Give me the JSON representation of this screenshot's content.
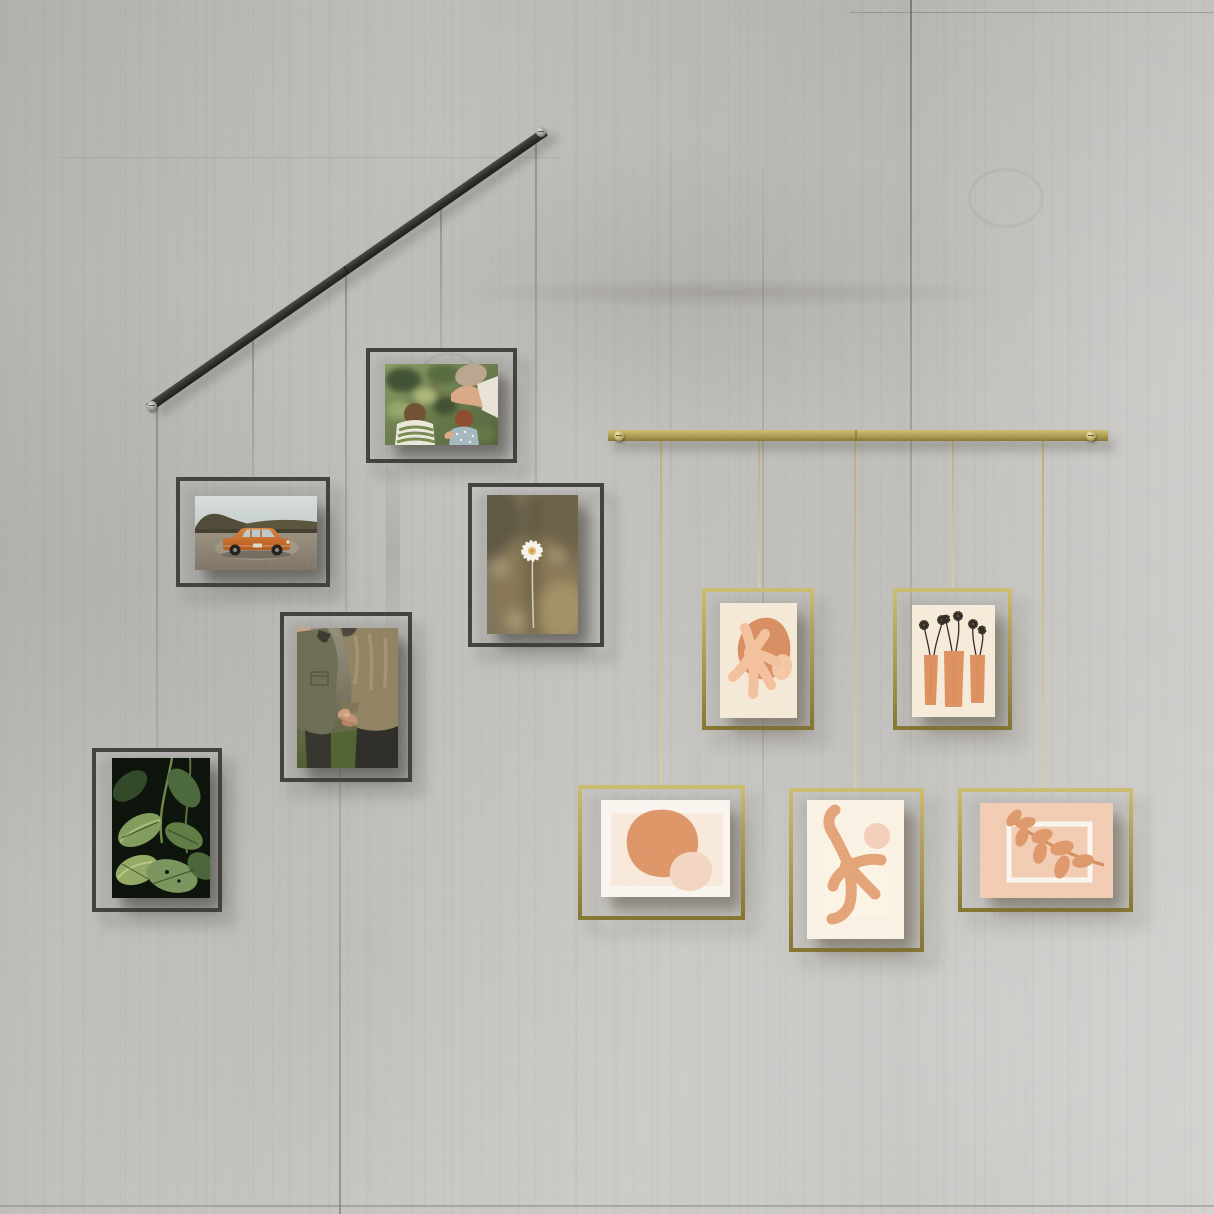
{
  "scene": {
    "type": "product lifestyle photo",
    "description": "Two picture-hanging rail systems with floating frames suspended by wires on a concrete wall",
    "wall": {
      "material": "concrete",
      "base_color": "#c1c0bd",
      "seam_color": "#6f6d68"
    }
  },
  "rails": [
    {
      "id": "black-rail",
      "label": "black metal hanging rail",
      "color": "#2e2c2a",
      "orientation": "diagonal",
      "screws": 2,
      "frames_hung": 5
    },
    {
      "id": "brass-rail",
      "label": "brass hanging rail",
      "color": "#ab9b4f",
      "orientation": "horizontal",
      "screws": 2,
      "frames_hung": 5
    }
  ],
  "wires": {
    "black_rail_wire_color": "#8f8f8d",
    "brass_rail_wire_color": "#d3c68e",
    "count": 10
  },
  "frames": [
    {
      "id": "family-garden",
      "rail": "black-rail",
      "orientation": "landscape",
      "frame_color": "#413f3b",
      "description": "Photo of two children and an adult picking berries in a garden",
      "palette": [
        "#87975f",
        "#5a6a41",
        "#b7a48c",
        "#e9e7d8",
        "#8a4a2c"
      ]
    },
    {
      "id": "vintage-car",
      "rail": "black-rail",
      "orientation": "landscape",
      "frame_color": "#413f3b",
      "description": "Photo of an orange vintage sedan parked on gravel below dark hills",
      "palette": [
        "#d3dad8",
        "#4e4936",
        "#968b7a",
        "#c96f2a"
      ]
    },
    {
      "id": "holding-hands",
      "rail": "black-rail",
      "orientation": "portrait",
      "frame_color": "#413f3b",
      "description": "Photo of a couple in field jackets holding hands",
      "palette": [
        "#6b6a52",
        "#8e8060",
        "#c89a79",
        "#51602f"
      ]
    },
    {
      "id": "daisy",
      "rail": "black-rail",
      "orientation": "portrait",
      "frame_color": "#413f3b",
      "description": "Photo of a single white daisy against blurred grasses",
      "palette": [
        "#7d7257",
        "#f5f2ea",
        "#e0bd6d"
      ]
    },
    {
      "id": "green-leaves",
      "rail": "black-rail",
      "orientation": "portrait",
      "frame_color": "#413f3b",
      "description": "Photo of dark tropical foliage",
      "palette": [
        "#0c120b",
        "#77935a",
        "#c8d296"
      ]
    },
    {
      "id": "coral-abstract",
      "rail": "brass-rail",
      "orientation": "portrait",
      "frame_color": "#ac9c51",
      "description": "Abstract print of a peach coral shape over a terracotta blob",
      "palette": [
        "#f4e8d5",
        "#d68c5f",
        "#f2bf9b"
      ]
    },
    {
      "id": "flower-vases",
      "rail": "brass-rail",
      "orientation": "portrait",
      "frame_color": "#ac9c51",
      "description": "Print of three orange vases with sketched black daisies",
      "palette": [
        "#f6ead8",
        "#dd8f5e",
        "#2e2820"
      ]
    },
    {
      "id": "terracotta-blob",
      "rail": "brass-rail",
      "orientation": "landscape",
      "frame_color": "#ac9c51",
      "description": "Print of a large terracotta blob with a pale peach pebble",
      "palette": [
        "#f9f4ee",
        "#f7e8da",
        "#dd9466",
        "#f2d4bf"
      ]
    },
    {
      "id": "coral-branch",
      "rail": "brass-rail",
      "orientation": "portrait",
      "frame_color": "#ac9c51",
      "description": "Print of a branching coral shape with a blush circle",
      "palette": [
        "#f9f1e3",
        "#e3a276",
        "#f3cdb8"
      ]
    },
    {
      "id": "leaf-sprig",
      "rail": "brass-rail",
      "orientation": "landscape",
      "frame_color": "#ac9c51",
      "description": "Print of a terracotta leaf sprig over a white outlined rectangle on blush",
      "palette": [
        "#f1cbb1",
        "#dd9768",
        "#faf5ec"
      ]
    }
  ]
}
